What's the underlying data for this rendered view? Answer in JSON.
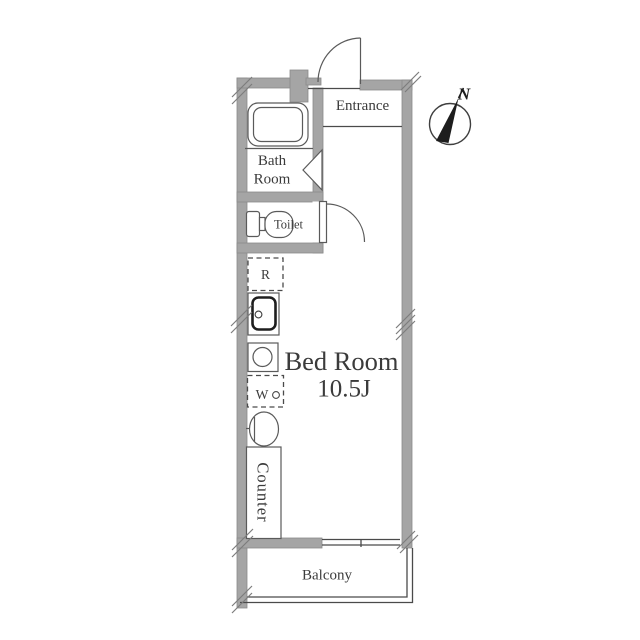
{
  "plan": {
    "labels": {
      "entrance": "Entrance",
      "bath_line1": "Bath",
      "bath_line2": "Room",
      "toilet": "Toilet",
      "refrigerator": "R",
      "washing_machine": "W",
      "bedroom_name": "Bed Room",
      "bedroom_size": "10.5J",
      "counter": "Counter",
      "balcony": "Balcony"
    },
    "compass": {
      "north": "N"
    },
    "colors": {
      "wall_fill": "#a5a5a5",
      "wall_edge": "#8a8a8a",
      "line": "#4a4a4a",
      "fixture_line": "#5a5a5a",
      "text": "#3b3b3b",
      "compass_needle": "#1d1d1d",
      "background": "#ffffff"
    }
  }
}
